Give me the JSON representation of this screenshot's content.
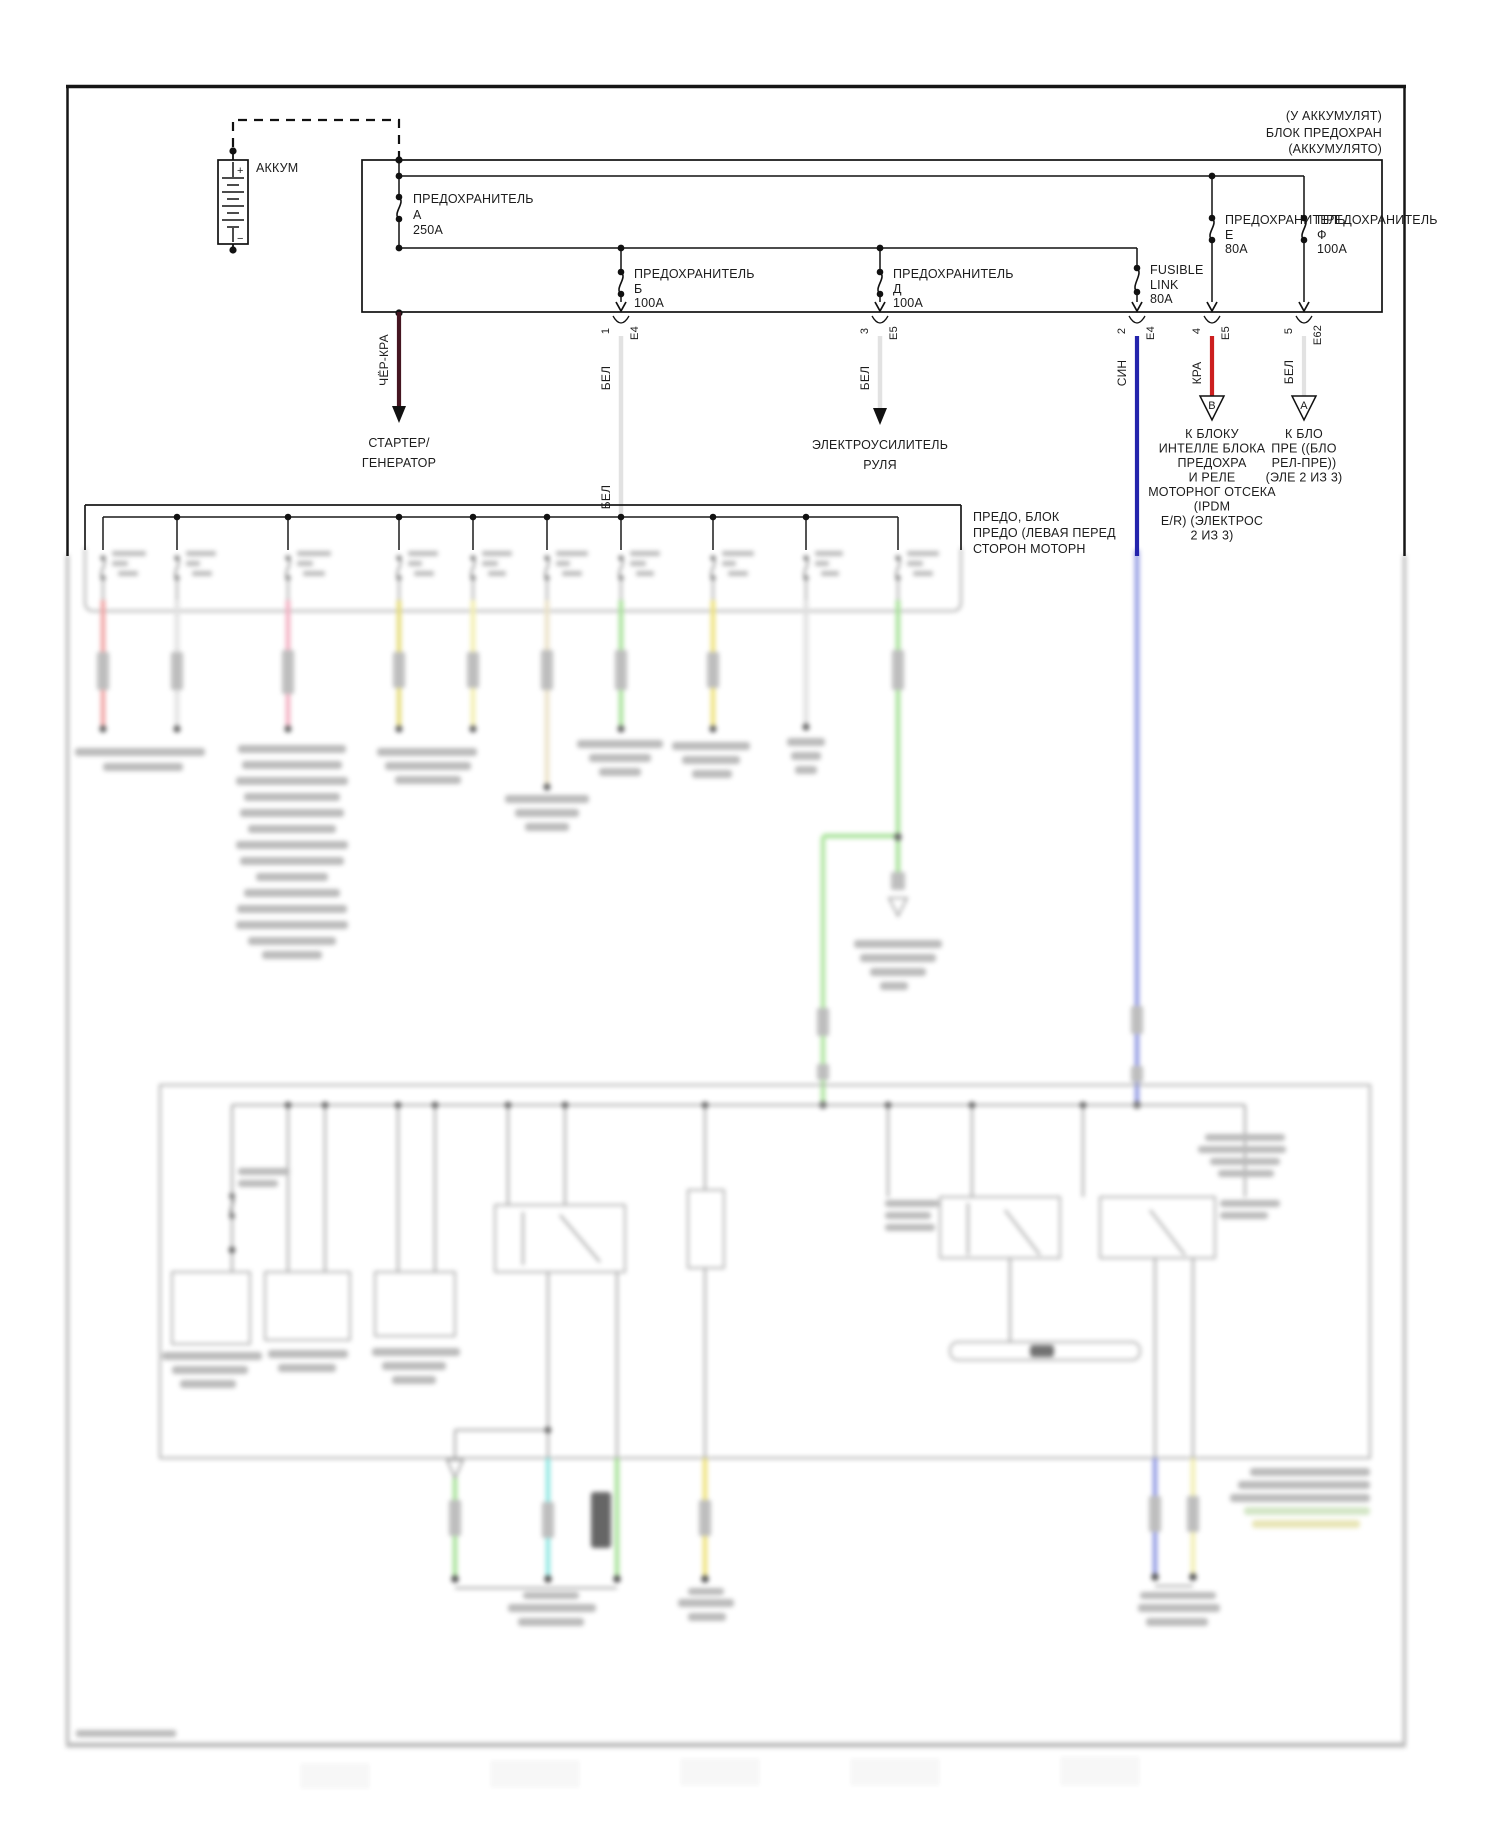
{
  "top_right_note": {
    "l1": "(У АККУМУЛЯТ)",
    "l2": "БЛОК ПРЕДОХРАН",
    "l3": "(АККУМУЛЯТО)"
  },
  "battery": {
    "label": "АККУМ",
    "plus": "+",
    "minus": "−"
  },
  "fuses": {
    "a": {
      "title": "ПРЕДОХРАНИТЕЛЬ",
      "id": "А",
      "rating": "250А"
    },
    "b": {
      "title": "ПРЕДОХРАНИТЕЛЬ",
      "id": "Б",
      "rating": "100А"
    },
    "d": {
      "title": "ПРЕДОХРАНИТЕЛЬ",
      "id": "Д",
      "rating": "100А"
    },
    "link": {
      "title": "FUSIBLE",
      "id": "LINK",
      "rating": "80А"
    },
    "e": {
      "title": "ПРЕДОХРАНИТЕЛЬ",
      "id": "Е",
      "rating": "80А"
    },
    "f": {
      "title": "ПРЕДОХРАНИТЕЛЬ",
      "id": "Ф",
      "rating": "100А"
    }
  },
  "pins": {
    "b": "1",
    "d": "3",
    "link": "2",
    "e": "4",
    "f": "5"
  },
  "connectors": {
    "b": "Е4",
    "d": "Е5",
    "link": "Е4",
    "e": "Е5",
    "f": "Е62"
  },
  "wire_labels": {
    "cher_kra": "ЧЁР-КРА",
    "bel_b_upper": "БЕЛ",
    "bel_b_lower": "БЕЛ",
    "bel_d": "БЕЛ",
    "sin": "СИН",
    "kra": "КРА",
    "bel_f": "БЕЛ"
  },
  "destinations": {
    "starter": {
      "l1": "СТАРТЕР/",
      "l2": "ГЕНЕРАТОР"
    },
    "eps": {
      "l1": "ЭЛЕКТРОУСИЛИТЕЛЬ",
      "l2": "РУЛЯ"
    },
    "triangle_b": "В",
    "triangle_a": "А",
    "ipdm": {
      "l1": "К БЛОКУ",
      "l2": "ИНТЕЛЛЕ БЛОКА",
      "l3": "ПРЕДОХРА",
      "l4": "И РЕЛЕ",
      "l5": "МОТОРНОГ ОТСЕКА",
      "l6": "(IPDM",
      "l7": "E/R) (ЭЛЕКТРОС",
      "l8": "2 ИЗ 3)"
    },
    "relay": {
      "l1": "К БЛО",
      "l2": "ПРЕ ((БЛО",
      "l3": "РЕЛ-ПРЕ))",
      "l4": "(ЭЛЕ 2 ИЗ 3)"
    }
  },
  "fuse_block_label": {
    "l1": "ПРЕДО, БЛОК",
    "l2": "ПРЕДО (ЛЕВАЯ ПЕРЕД",
    "l3": "СТОРОН МОТОРН"
  },
  "colors": {
    "black_red_wire": "#451521",
    "white_wire": "#e2e2e2",
    "blue_wire": "#2424ac",
    "red_wire": "#cc1f1f",
    "green_wire": "#9fdf8f",
    "cyan_wire": "#86e5e0",
    "yellow_wire": "#e3d96e",
    "pale_yellow_wire": "#f2eda6",
    "pink_wire": "#f2a8bc",
    "salmon_wire": "#ef9a9a",
    "blurred_blue_wire": "#8890e0"
  }
}
